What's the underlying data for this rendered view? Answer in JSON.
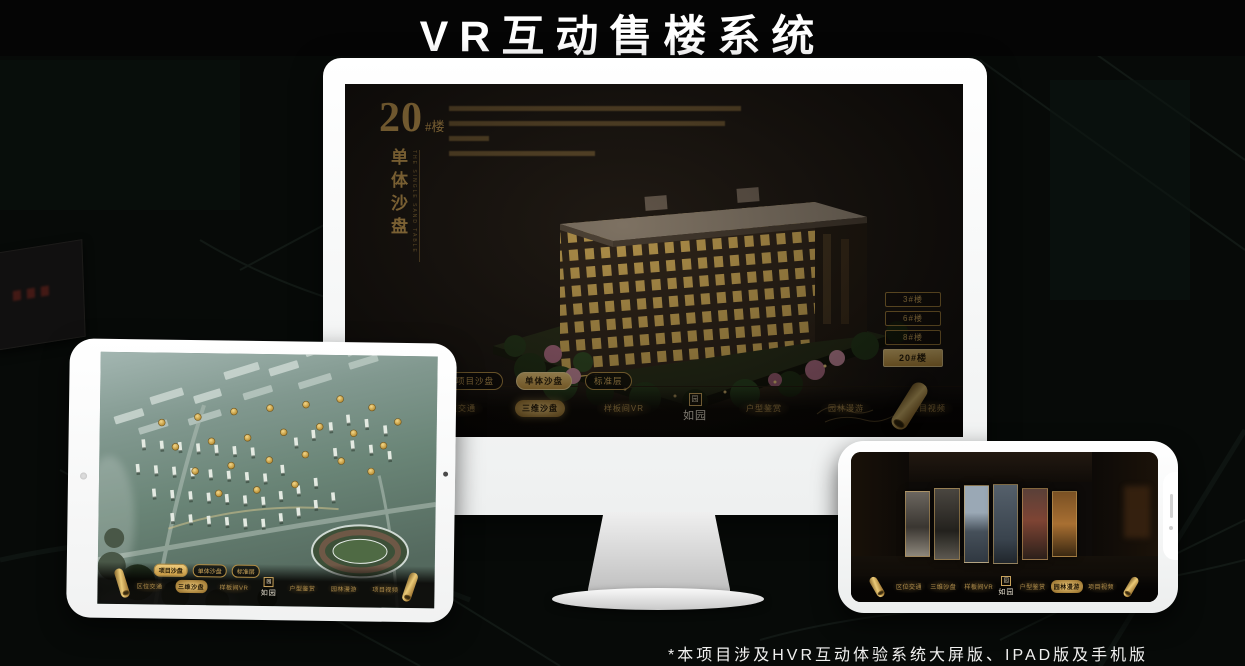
{
  "header": {
    "title": "VR互动售楼系统"
  },
  "footer": {
    "note": "*本项目涉及HVR互动体验系统大屏版、IPAD版及手机版"
  },
  "brand": {
    "name": "如园",
    "seal": "园"
  },
  "colors": {
    "gold": "#c99c50",
    "gold_bright": "#ecc979",
    "screen_bg": "#171310",
    "accent_text": "#d2a95c"
  },
  "monitor": {
    "hero": {
      "number": "20",
      "suffix": "#楼",
      "vertical_title": "单体沙盘",
      "vertical_subtitle": "THE SINGLE SAND TABLE"
    },
    "floor_buttons": [
      {
        "label": "3#楼",
        "active": false
      },
      {
        "label": "6#楼",
        "active": false
      },
      {
        "label": "8#楼",
        "active": false
      },
      {
        "label": "20#楼",
        "active": true
      }
    ],
    "tabs": [
      {
        "label": "项目沙盘",
        "active": false
      },
      {
        "label": "单体沙盘",
        "active": true
      },
      {
        "label": "标准层",
        "active": false
      }
    ],
    "menu": [
      {
        "label": "区位交通",
        "active": false
      },
      {
        "label": "三维沙盘",
        "active": true
      },
      {
        "label": "样板间VR",
        "active": false
      },
      {
        "label": "户型鉴赏",
        "active": false
      },
      {
        "label": "园林漫游",
        "active": false
      },
      {
        "label": "项目视频",
        "active": false
      }
    ]
  },
  "tablet": {
    "tabs": [
      {
        "label": "项目沙盘",
        "active": true
      },
      {
        "label": "单体沙盘",
        "active": false
      },
      {
        "label": "标准层",
        "active": false
      }
    ],
    "menu": [
      {
        "label": "区位交通",
        "active": false
      },
      {
        "label": "三维沙盘",
        "active": true
      },
      {
        "label": "样板间VR",
        "active": false
      },
      {
        "label": "户型鉴赏",
        "active": false
      },
      {
        "label": "园林漫游",
        "active": false
      },
      {
        "label": "项目视频",
        "active": false
      }
    ]
  },
  "phone": {
    "menu": [
      {
        "label": "区位交通",
        "active": false
      },
      {
        "label": "三维沙盘",
        "active": false
      },
      {
        "label": "样板间VR",
        "active": false
      },
      {
        "label": "户型鉴赏",
        "active": false
      },
      {
        "label": "园林漫游",
        "active": true
      },
      {
        "label": "项目视频",
        "active": false
      }
    ]
  }
}
